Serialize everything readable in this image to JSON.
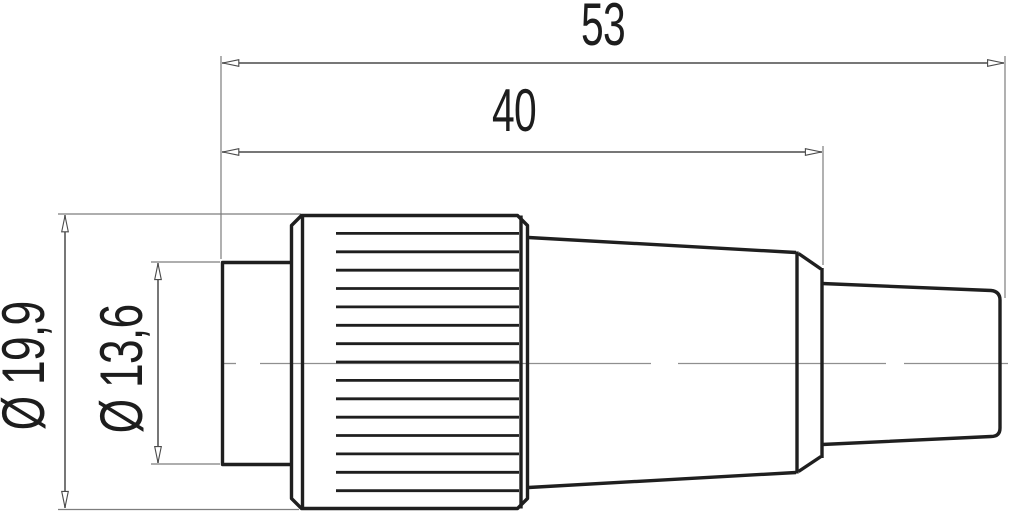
{
  "drawing": {
    "description": "Side view technical dimension drawing of a circular cable connector with knurled coupling ring and cable gland",
    "dimensions": {
      "overall_length": "53",
      "body_length": "40",
      "coupling_diameter": "Ø 19,9",
      "front_diameter": "Ø 13,6"
    },
    "colors": {
      "outline": "#1f1f1f",
      "dimension_line": "#4a4a4a",
      "extension_line": "#7d7d7d",
      "center_line": "#8f8f8f",
      "arrow_fill": "#ffffff",
      "text": "#1d1d1d",
      "background": "#ffffff"
    }
  }
}
